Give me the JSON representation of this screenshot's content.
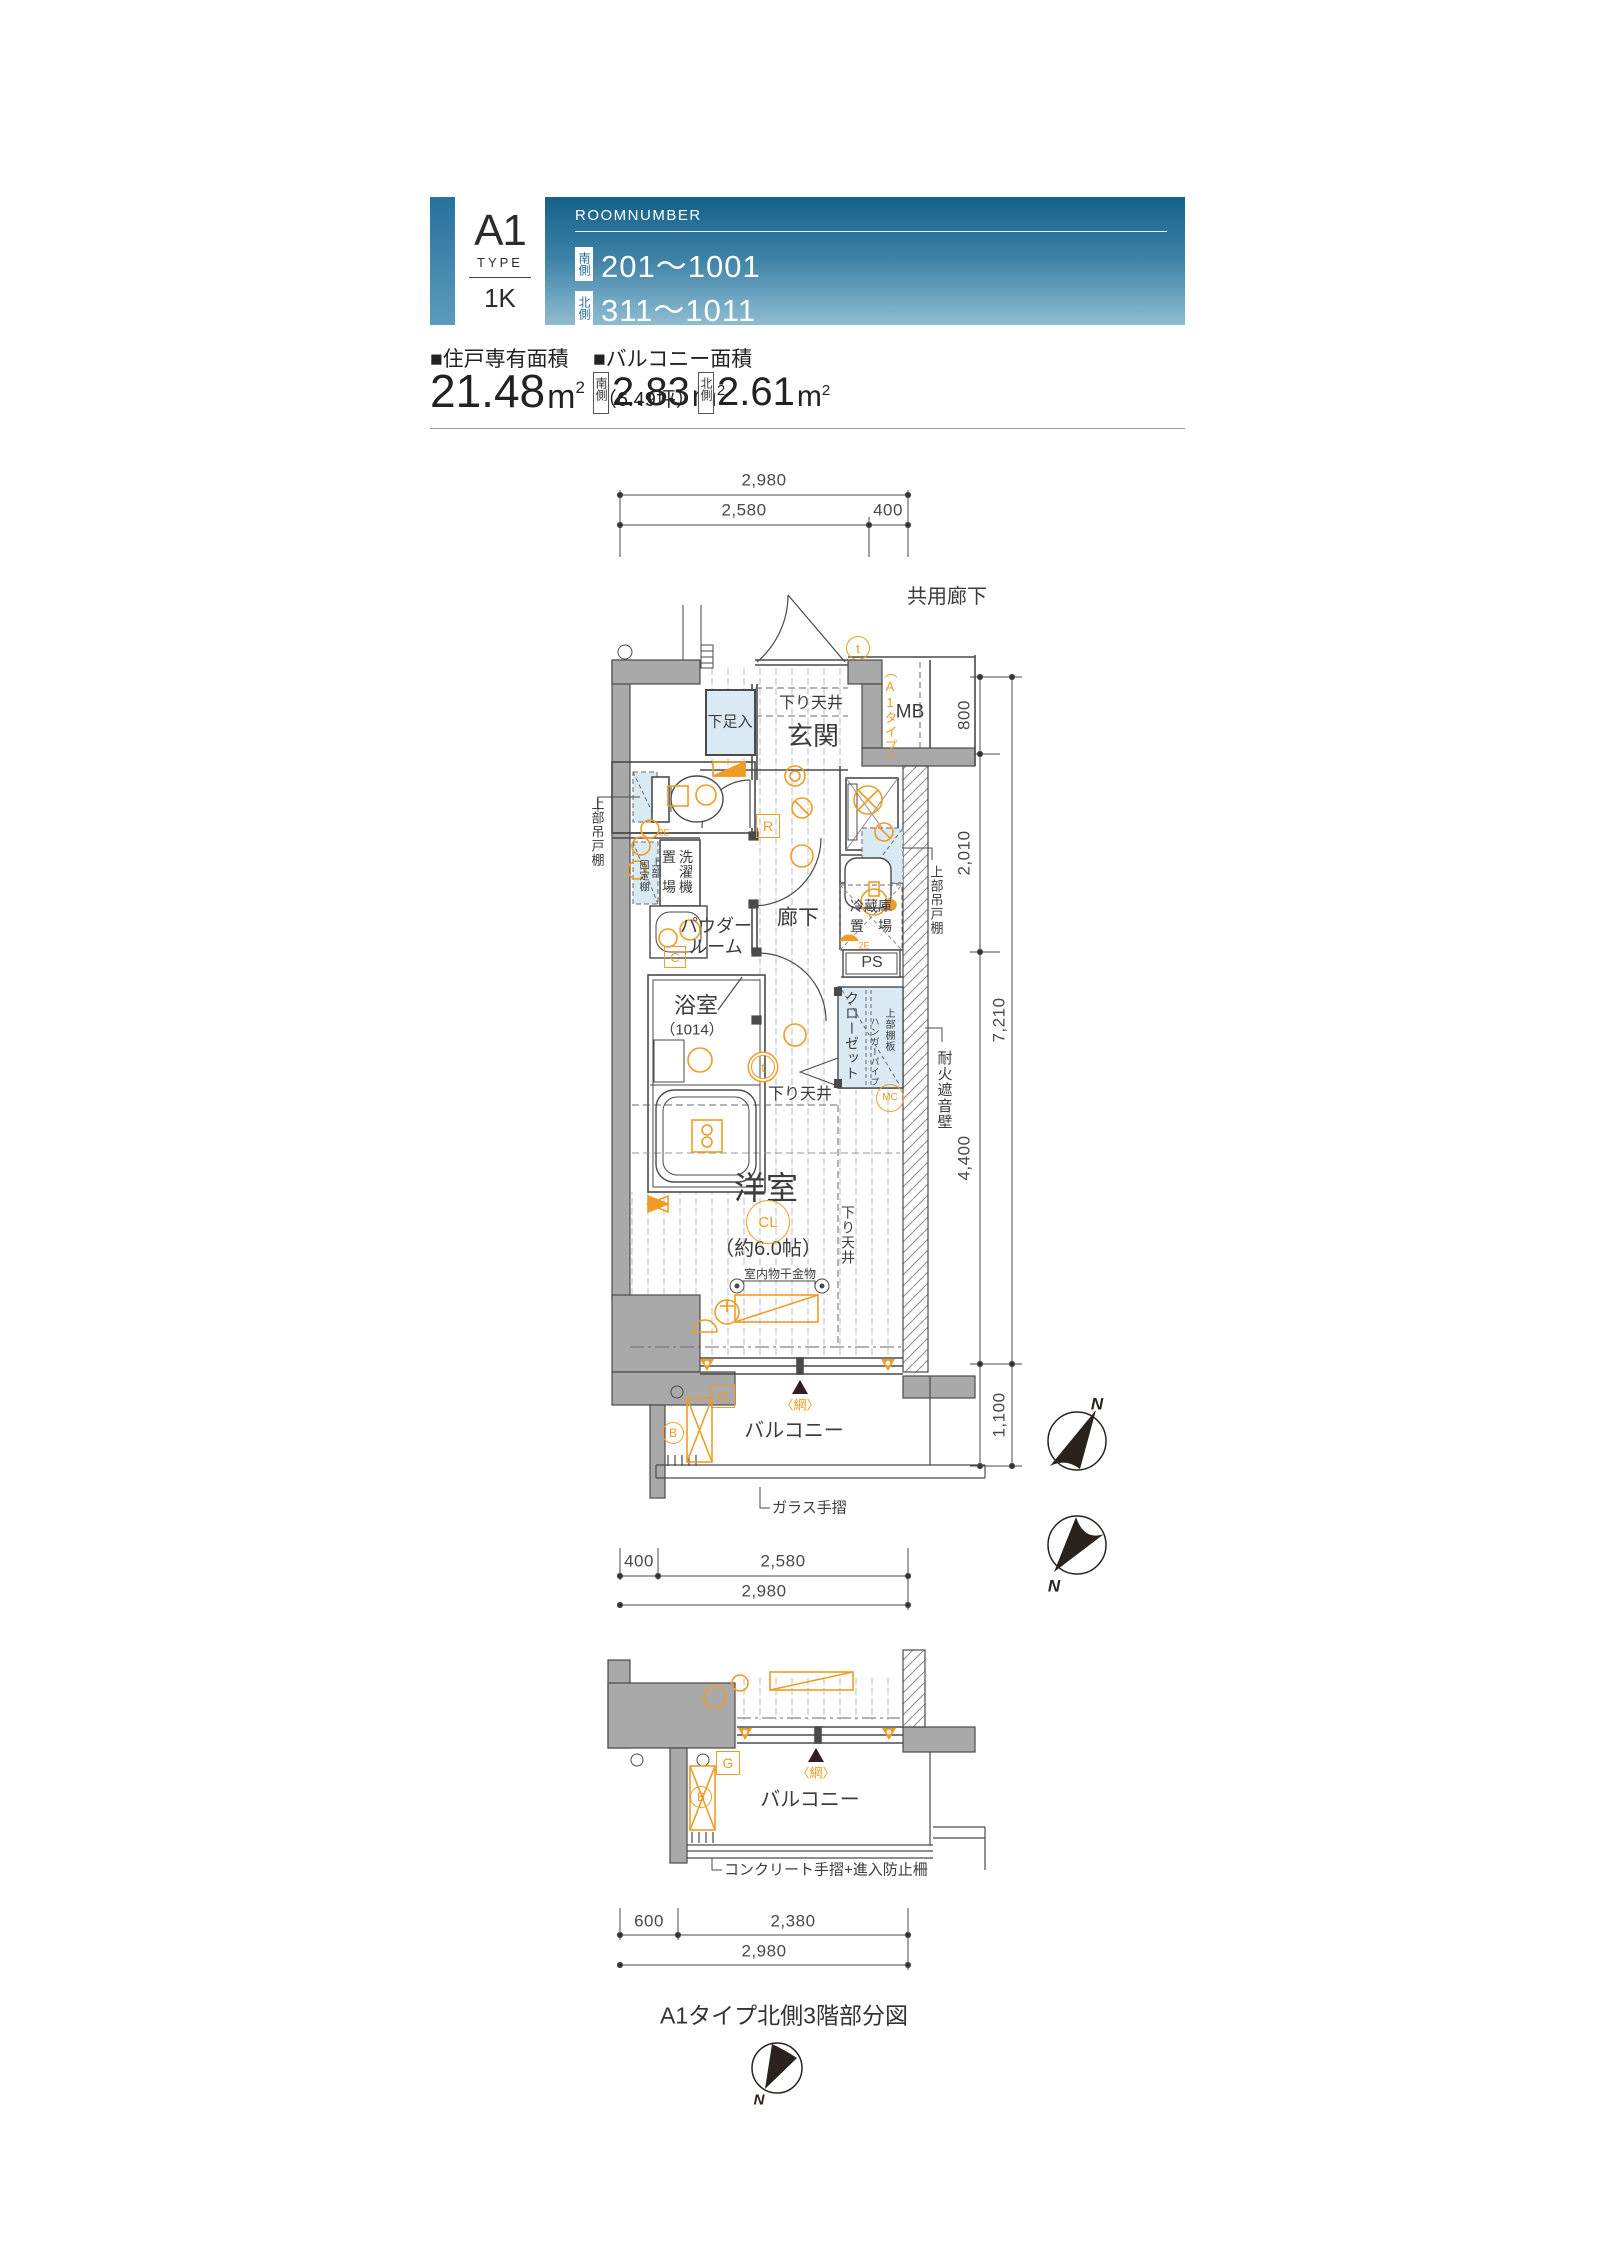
{
  "header": {
    "type_code": "A1",
    "type_label": "TYPE",
    "plan_type": "1K",
    "roomnumber_label": "ROOMNUMBER",
    "south_badge": "南側",
    "south_numbers": "201〜1001",
    "north_badge": "北側",
    "north_numbers": "311〜1011"
  },
  "area": {
    "unit_label": "■住戸専有面積",
    "unit_value": "21.48",
    "unit_m": "m",
    "sup": "2",
    "unit_tsubo": "（6.49坪）",
    "balcony_label": "■バルコニー面積",
    "south_badge": "南側",
    "south_value": "2.83",
    "north_badge": "北側",
    "north_value": "2.61"
  },
  "dims": {
    "d2980": "2,980",
    "d2580": "2,580",
    "d400": "400",
    "d800": "800",
    "d2010": "2,010",
    "d7210": "7,210",
    "d4400": "4,400",
    "d1100": "1,100",
    "d600": "600",
    "d2380": "2,380"
  },
  "labels": {
    "common_corridor": "共用廊下",
    "entrance": "玄関",
    "shoe_cabinet": "下足入",
    "dropped_ceiling": "下り天井",
    "mb": "MB",
    "a1_tag": "（A1タイプ）",
    "upper_cabinet": "上部吊戸棚",
    "washer_col1": "洗濯機",
    "washer_col2": "置　場",
    "fixed_shelf": "固定棚",
    "upper": "上部",
    "powder_l1": "パウダー",
    "powder_l2": "ルーム",
    "bath": "浴室",
    "bath_size": "（1014）",
    "corridor": "廊下",
    "fridge_l1": "冷蔵庫",
    "fridge_l2": "置　場",
    "ps": "PS",
    "closet": "クローゼット",
    "shelf_board": "上部棚板",
    "hanger_pipe": "ハンガーパイプ",
    "fire_wall": "耐火遮音壁",
    "west_room": "洋室",
    "west_room_size": "（約6.0帖）",
    "cl": "CL",
    "laundry_bar": "室内物干金物",
    "balcony": "バルコニー",
    "glass_rail": "ガラス手摺",
    "net": "〈網〉",
    "mark_t": "t",
    "mark_r": "R",
    "mark_c": "C",
    "mark_g": "G",
    "mark_b": "B",
    "mark_mc": "MC",
    "mark_2e": "2E"
  },
  "partial": {
    "title": "A1タイプ北側3階部分図",
    "concrete_rail": "コンクリート手摺+進入防止柵"
  },
  "compass": {
    "n": "N"
  },
  "colors": {
    "accent_orange": "#EF9C26",
    "wall_gray": "#A9A9A9",
    "light_blue": "#D9EAF5",
    "header_top": "#15618A",
    "header_bottom": "#8FBCD2"
  }
}
